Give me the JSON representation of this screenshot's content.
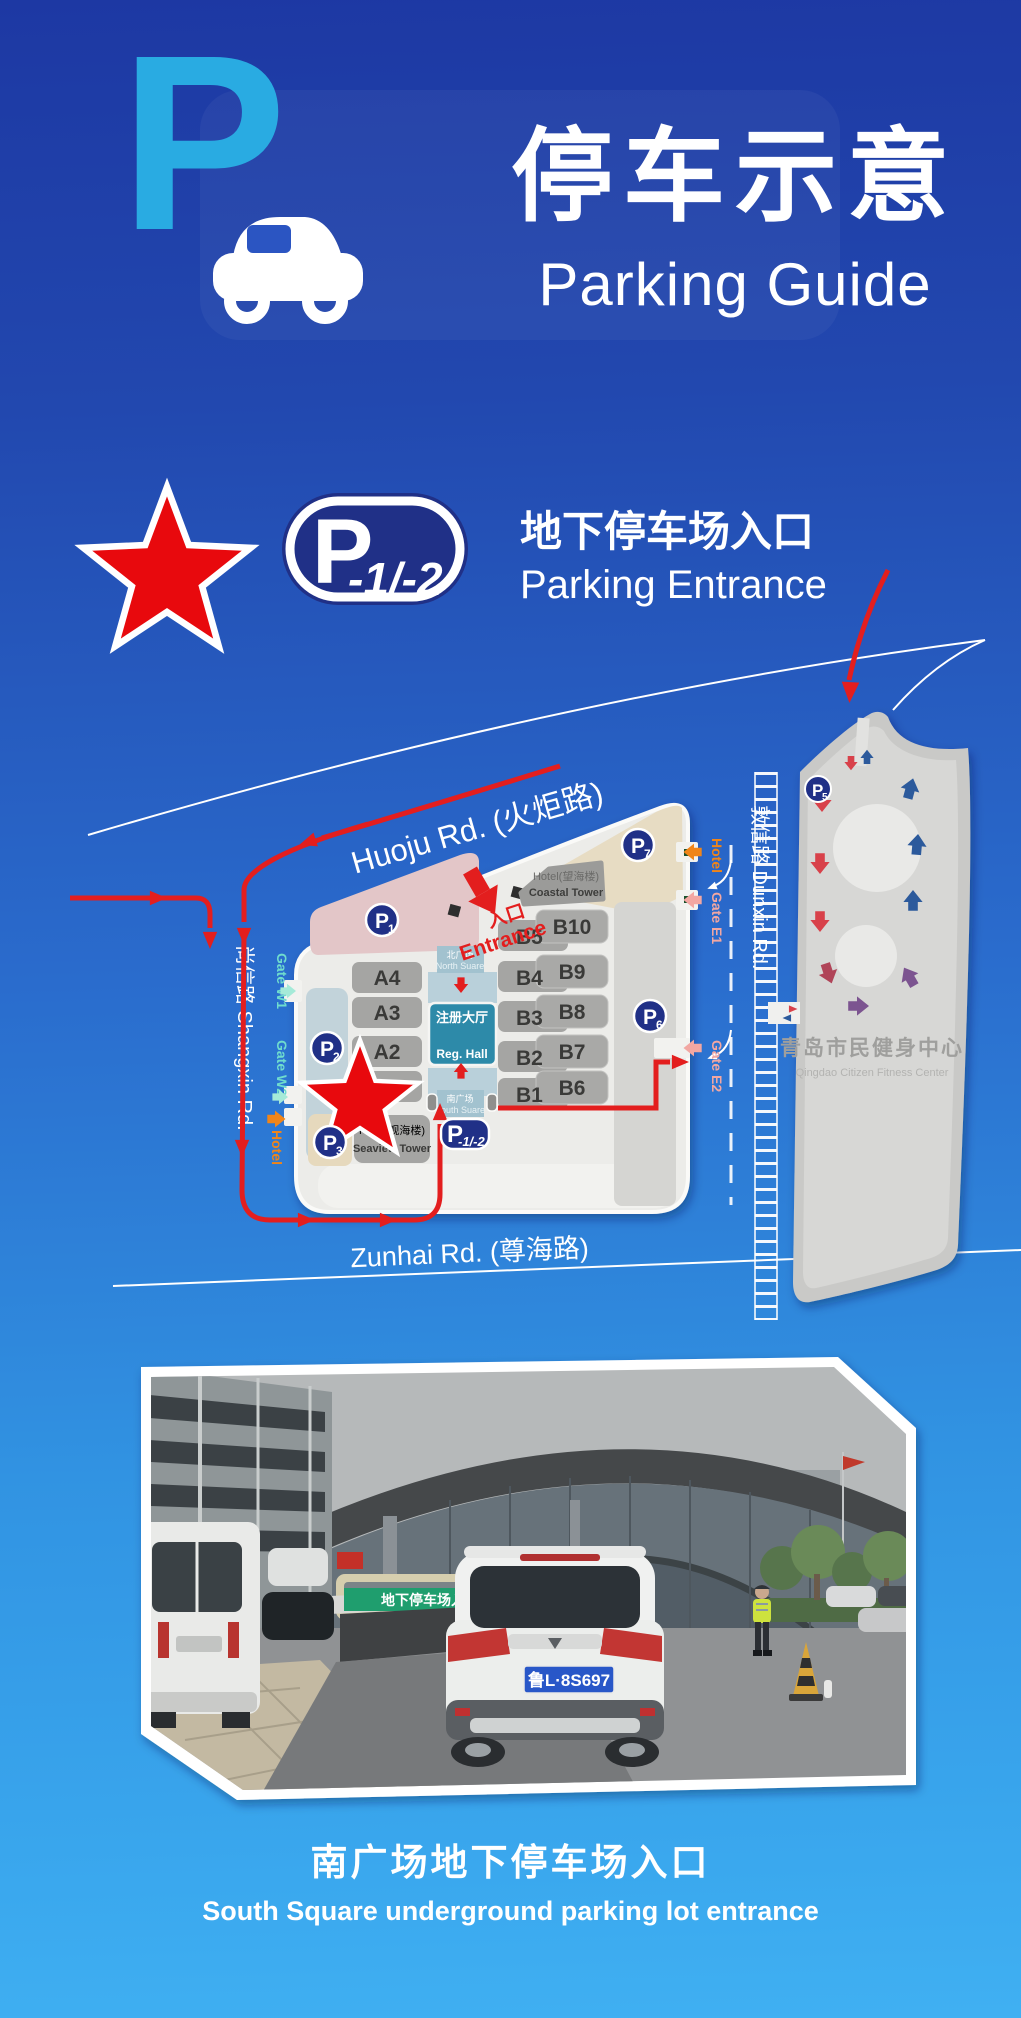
{
  "header": {
    "logo_letter": "P",
    "title_zh": "停车示意",
    "title_en": "Parking Guide"
  },
  "legend": {
    "badge_p": "P",
    "badge_sub": "-1/-2",
    "label_zh": "地下停车场入口",
    "label_en": "Parking Entrance"
  },
  "map": {
    "roads": {
      "huoju": "Huoju Rd. (火炬路)",
      "shangxin": "尚信路 Shangxin Rd.",
      "dunxin": "敦信路 Dunxin Rd.",
      "zunhai": "Zunhai Rd. (尊海路)"
    },
    "entrance": {
      "zh": "入口",
      "en": "Entrance"
    },
    "gates": {
      "w1": "Gate W1",
      "w2": "Gate W2",
      "hotel_w": "Hotel",
      "e1": "Gate E1",
      "e2": "Gate E2",
      "hotel_e": "Hotel"
    },
    "halls_a": [
      "A4",
      "A3",
      "A2"
    ],
    "halls_b_left": [
      "B5",
      "B4",
      "B3",
      "B2",
      "B1"
    ],
    "halls_b_right": [
      "B10",
      "B9",
      "B8",
      "B7",
      "B6"
    ],
    "reg_hall": {
      "zh": "注册大厅",
      "en": "Reg. Hall"
    },
    "north_square": {
      "zh": "北广场",
      "en": "North Suare"
    },
    "south_square": {
      "zh": "南广场",
      "en": "South Suare"
    },
    "coastal": {
      "zh": "Hotel(望海楼)",
      "en": "Coastal Tower"
    },
    "seaview": {
      "zh": "Hotel(观海楼)",
      "en": "Seaview Tower"
    },
    "badges": [
      {
        "p": "P",
        "sub": "1"
      },
      {
        "p": "P",
        "sub": "2"
      },
      {
        "p": "P",
        "sub": "3"
      },
      {
        "p": "P",
        "sub": "5"
      },
      {
        "p": "P",
        "sub": "6"
      },
      {
        "p": "P",
        "sub": "7"
      }
    ],
    "entrance_badge": {
      "p": "P",
      "sub": "-1/-2"
    },
    "fitness": {
      "zh": "青岛市民健身中心",
      "en": "Qingdao Citizen Fitness Center"
    }
  },
  "photo": {
    "ramp_sign": "地下停车场入口",
    "license_plate": "鲁L·8S697"
  },
  "caption": {
    "zh": "南广场地下停车场入口",
    "en": "South Square underground parking lot entrance"
  },
  "colors": {
    "accent_cyan": "#29abe2",
    "badge_navy": "#203087",
    "route_red": "#e31e1e",
    "star_red": "#e8090d",
    "gate_mint": "#6fdccd",
    "gate_orange": "#f08519",
    "gate_salmon": "#f2a7a2",
    "reg_hall_teal": "#2d8aa9",
    "square_blue": "#aecdd9",
    "sign_green": "#1f9e6e",
    "plate_blue": "#2857c8"
  }
}
